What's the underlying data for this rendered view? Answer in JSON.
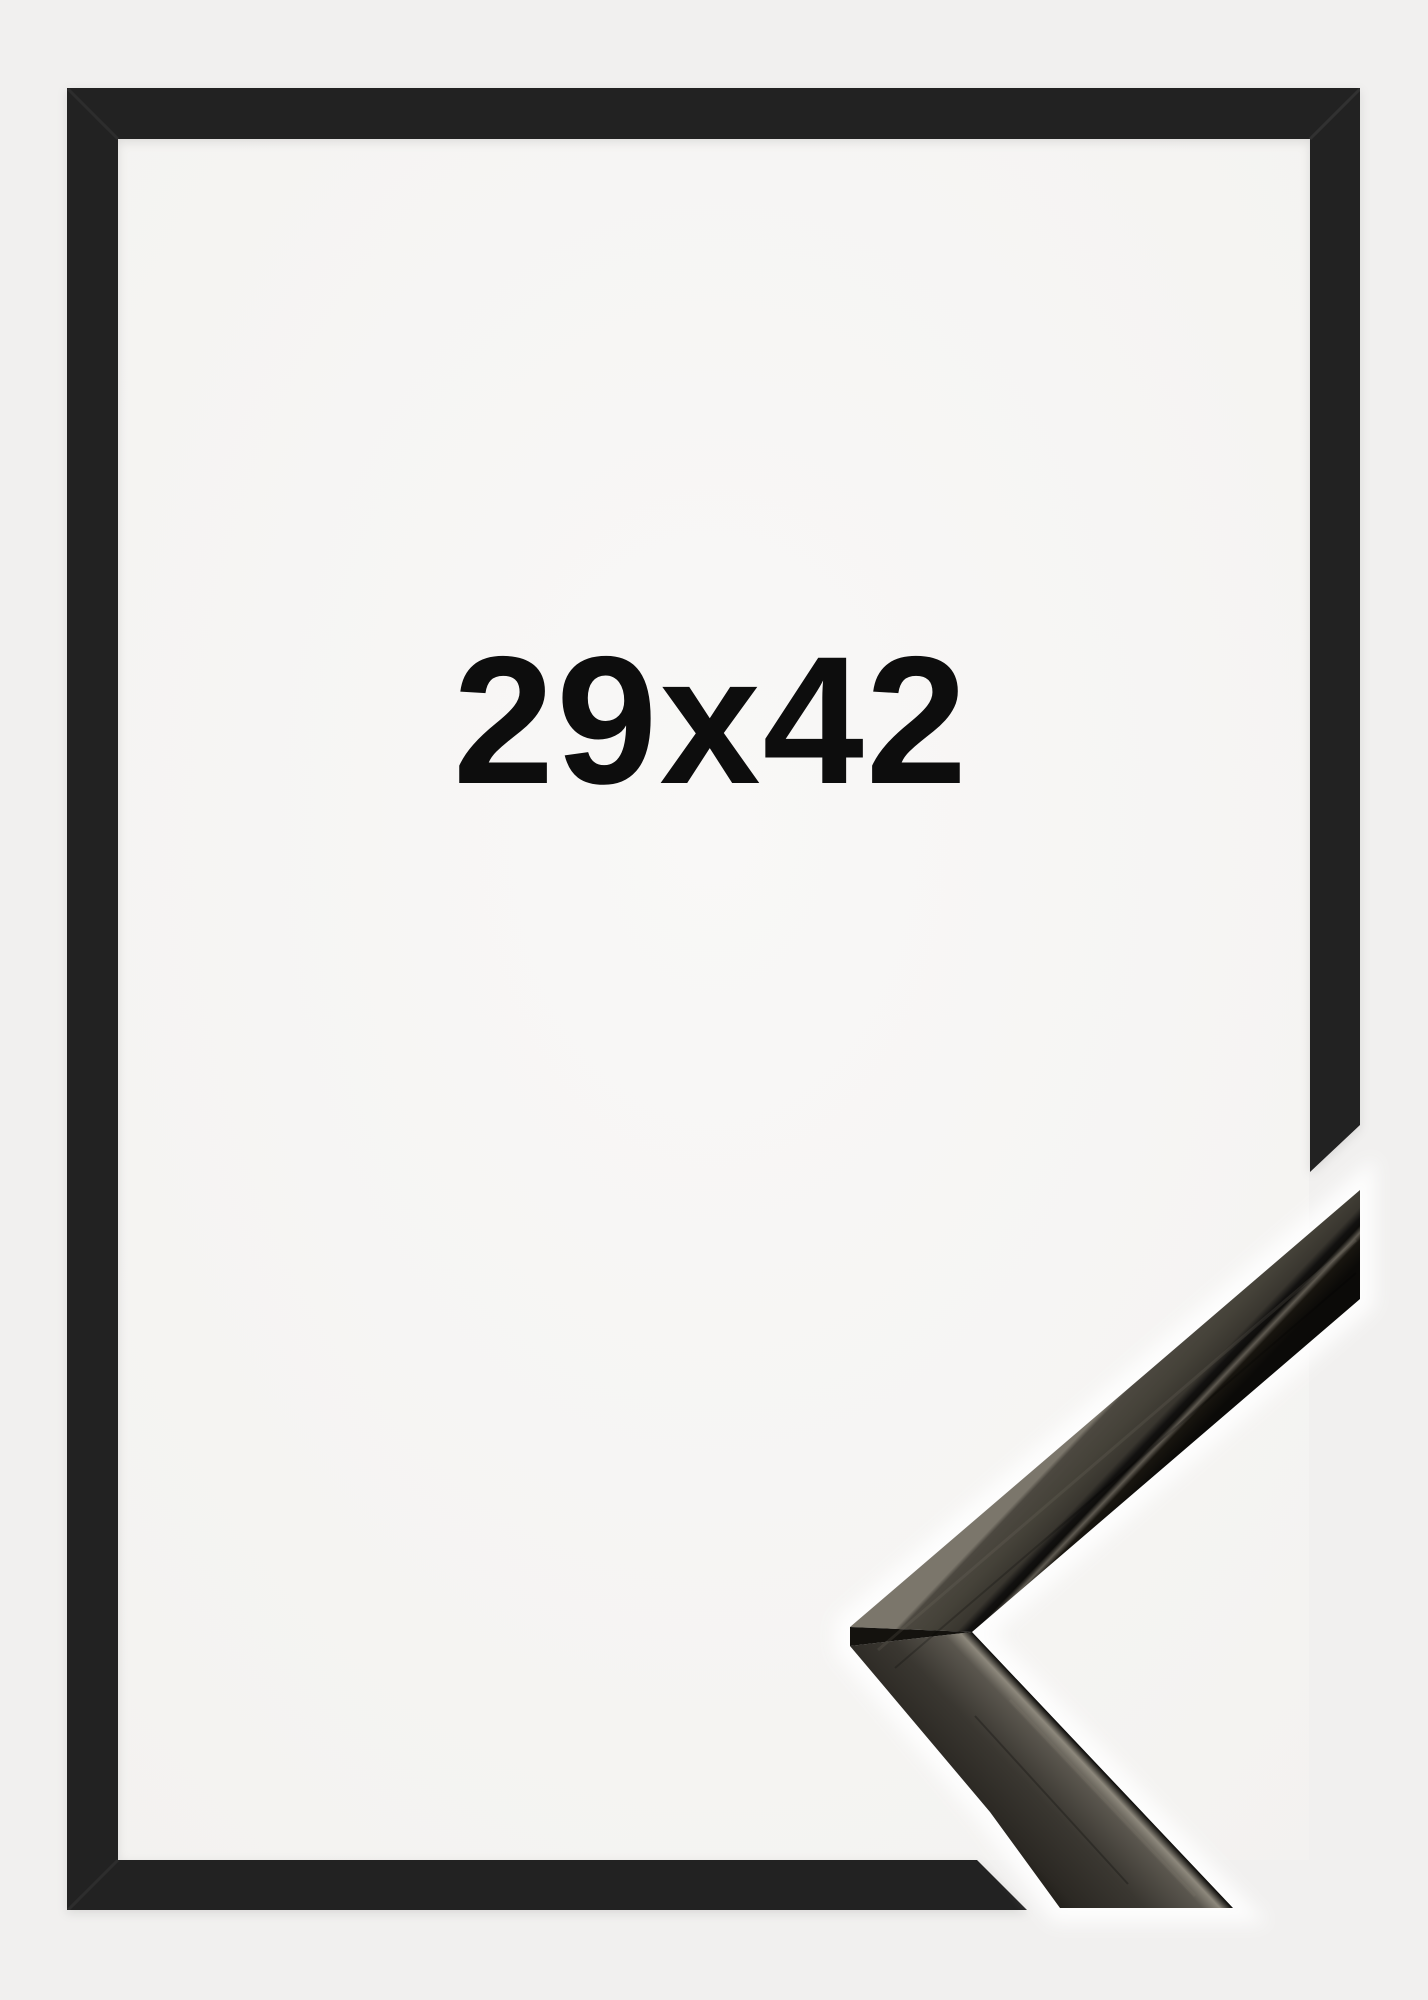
{
  "product_photo": {
    "size_label": "29x42",
    "colors": {
      "background": "#f1f0ef",
      "inner_area": "#f7f6f5",
      "frame_black": "#212020",
      "label_text": "#0d0d0d",
      "sample_wood_face": "#3a3731",
      "sample_wood_highlight": "#8d887c"
    }
  }
}
